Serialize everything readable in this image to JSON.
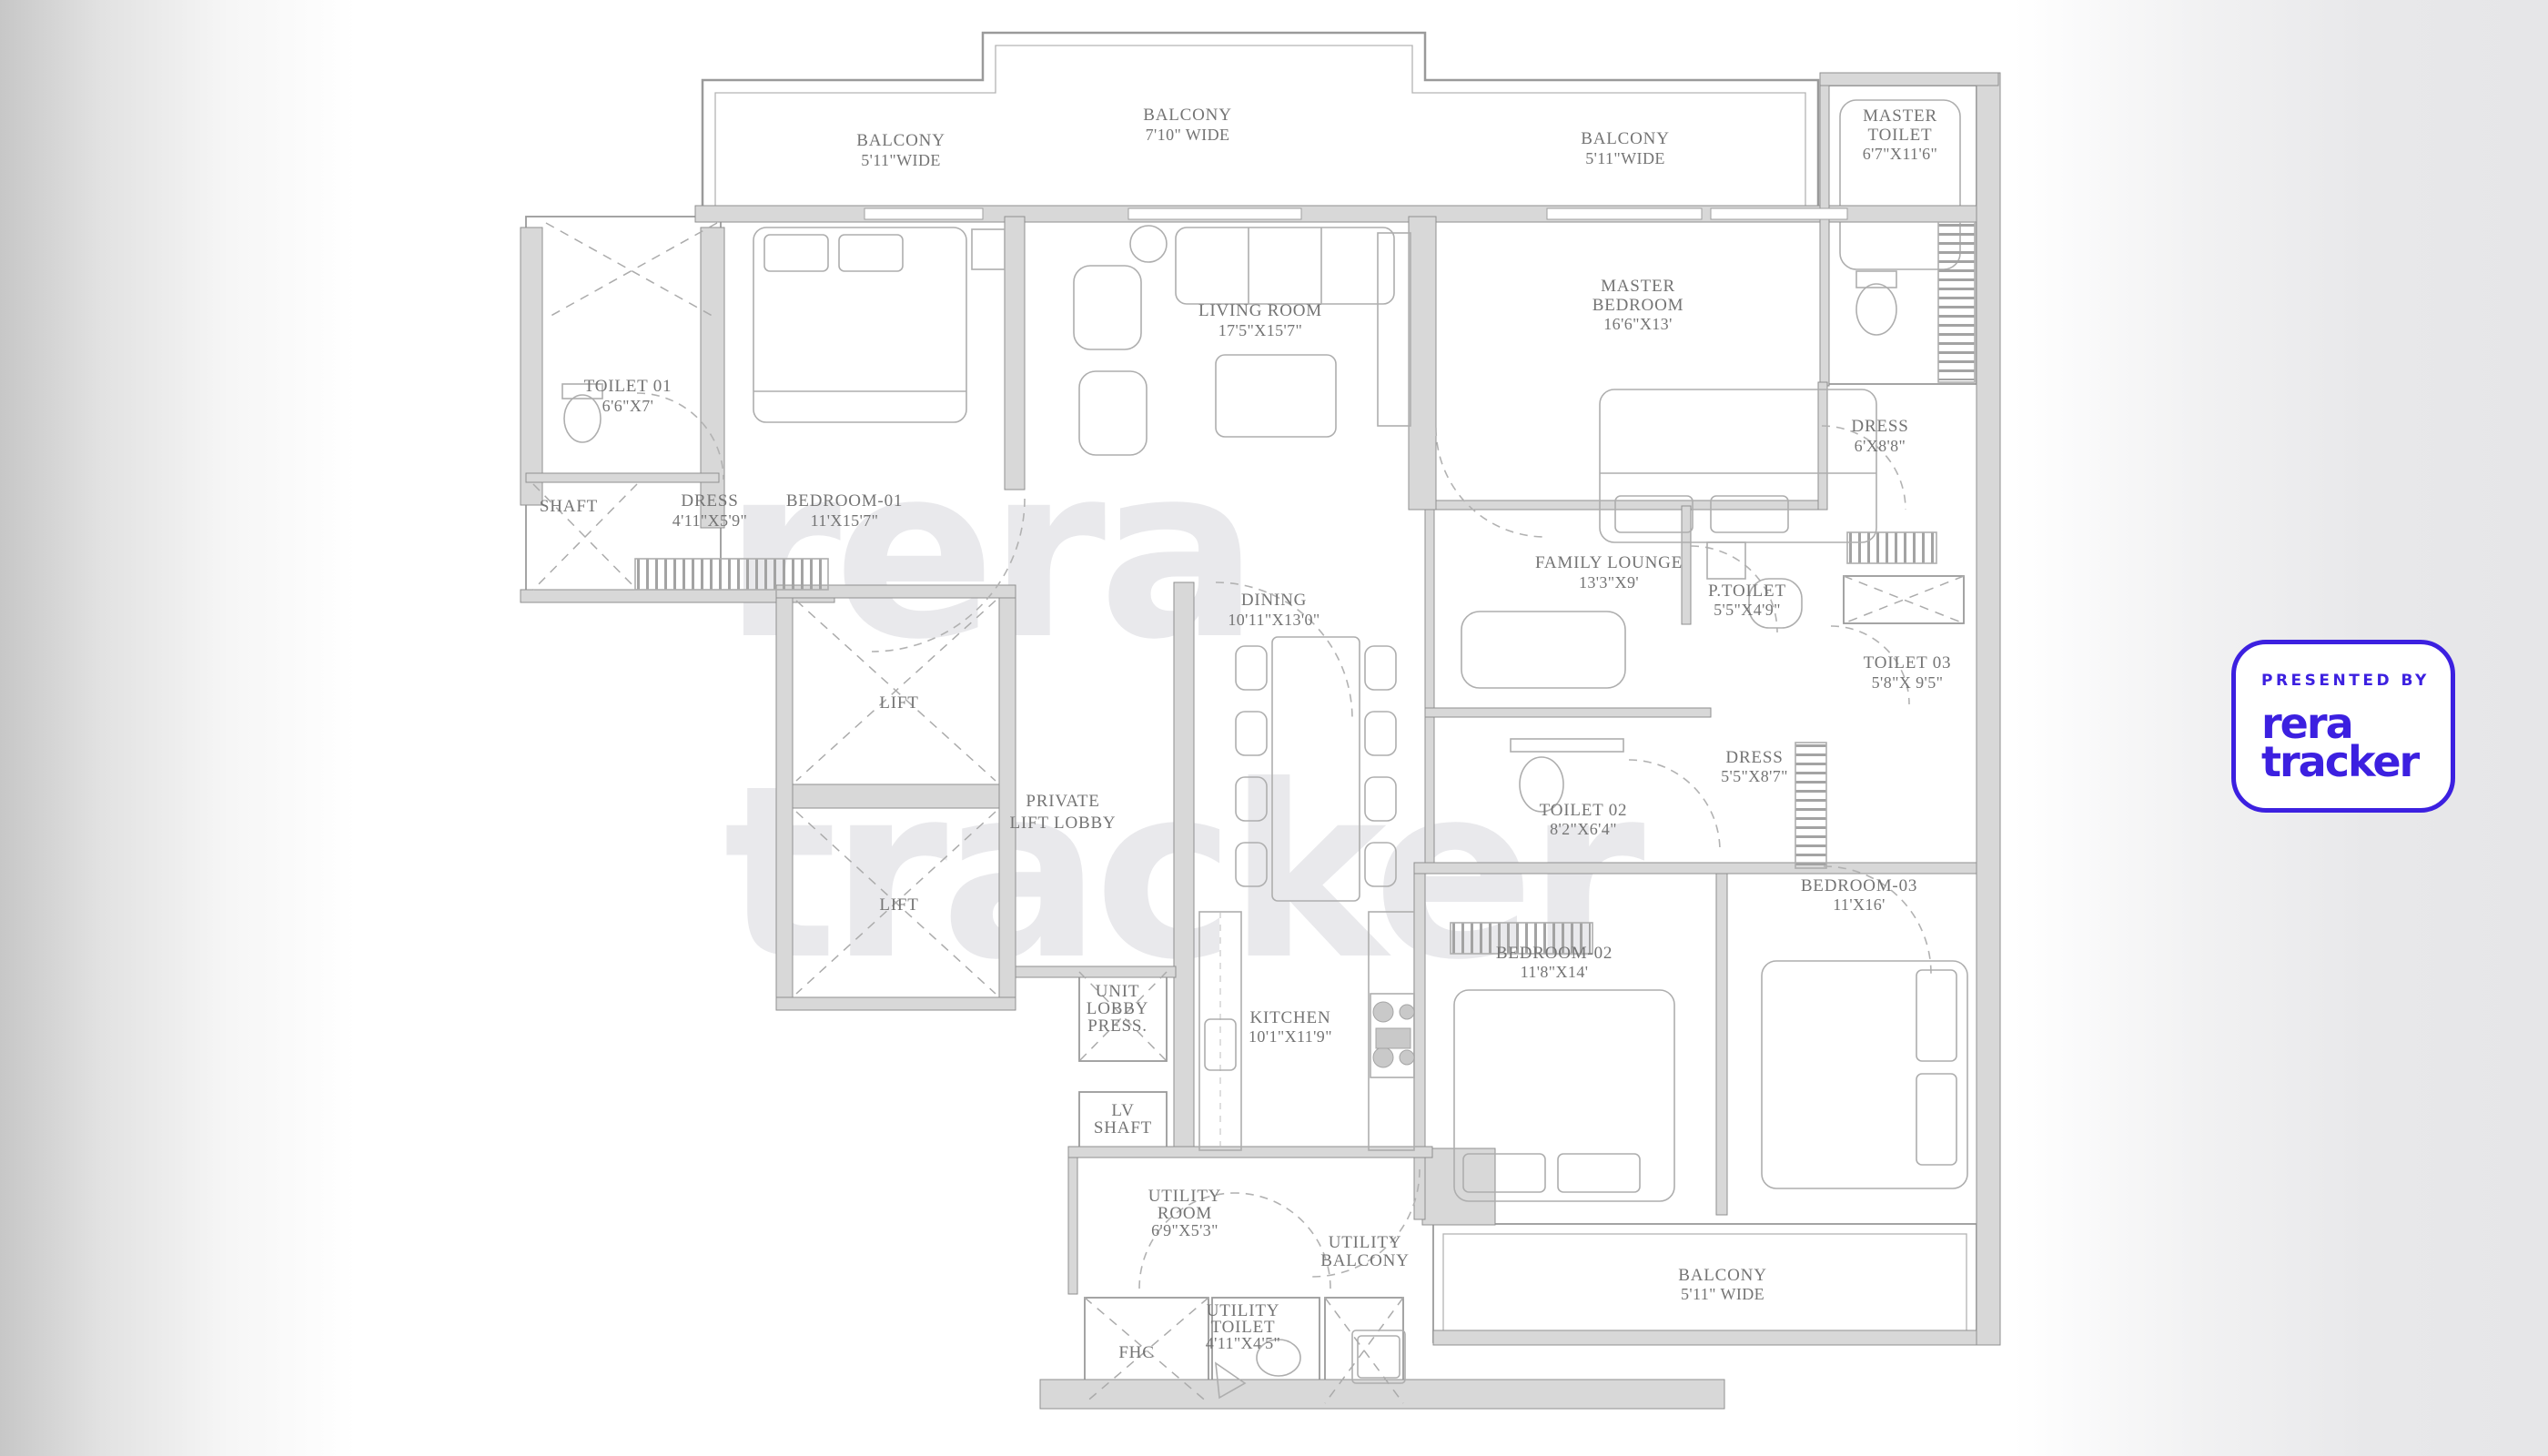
{
  "watermark": {
    "line1": "rera",
    "line2": "tracker"
  },
  "badge": {
    "presented_by": "PRESENTED BY",
    "brand_top": "rera",
    "brand_bottom": "tracker"
  },
  "colors": {
    "brand": "#3c20e0",
    "watermark": "#e9e9ec",
    "wall_fill": "#d8d8d8",
    "label_text": "#747474"
  },
  "rooms": {
    "balcony_top_left": {
      "lines": [
        "BALCONY",
        "5'11\"WIDE"
      ]
    },
    "balcony_top_center": {
      "lines": [
        "BALCONY",
        "7'10\" WIDE"
      ]
    },
    "balcony_top_right": {
      "lines": [
        "BALCONY",
        "5'11\"WIDE"
      ]
    },
    "master_toilet": {
      "lines": [
        "MASTER",
        "TOILET",
        "6'7\"X11'6\""
      ]
    },
    "living_room": {
      "lines": [
        "LIVING ROOM",
        "17'5\"X15'7\""
      ]
    },
    "master_bedroom": {
      "lines": [
        "MASTER",
        "BEDROOM",
        "16'6\"X13'"
      ]
    },
    "toilet_01": {
      "lines": [
        "TOILET 01",
        "6'6\"X7'"
      ]
    },
    "shaft": {
      "lines": [
        "SHAFT"
      ]
    },
    "dress_01": {
      "lines": [
        "DRESS",
        "4'11\"X5'9\""
      ]
    },
    "bedroom_01": {
      "lines": [
        "BEDROOM-01",
        "11'X15'7\""
      ]
    },
    "dress_master": {
      "lines": [
        "DRESS",
        "6'X8'8\""
      ]
    },
    "family_lounge": {
      "lines": [
        "FAMILY LOUNGE",
        "13'3\"X9'"
      ]
    },
    "p_toilet": {
      "lines": [
        "P.TOILET",
        "5'5\"X4'9\""
      ]
    },
    "toilet_03": {
      "lines": [
        "TOILET 03",
        "5'8\"X 9'5\""
      ]
    },
    "dining": {
      "lines": [
        "DINING",
        "10'11\"X13'0\""
      ]
    },
    "lift_1": {
      "lines": [
        "LIFT"
      ]
    },
    "lift_2": {
      "lines": [
        "LIFT"
      ]
    },
    "private_lift_lobby": {
      "lines": [
        "PRIVATE",
        "LIFT LOBBY"
      ]
    },
    "dress_03": {
      "lines": [
        "DRESS",
        "5'5\"X8'7\""
      ]
    },
    "toilet_02": {
      "lines": [
        "TOILET 02",
        "8'2\"X6'4\""
      ]
    },
    "bedroom_02": {
      "lines": [
        "BEDROOM-02",
        "11'8\"X14'"
      ]
    },
    "bedroom_03": {
      "lines": [
        "BEDROOM-03",
        "11'X16'"
      ]
    },
    "kitchen": {
      "lines": [
        "KITCHEN",
        "10'1\"X11'9\""
      ]
    },
    "unit_lobby_press": {
      "lines": [
        "UNIT",
        "LOBBY",
        "PRESS."
      ]
    },
    "lv_shaft": {
      "lines": [
        "LV",
        "SHAFT"
      ]
    },
    "utility_room": {
      "lines": [
        "UTILITY",
        "ROOM",
        "6'9\"X5'3\""
      ]
    },
    "utility_balcony": {
      "lines": [
        "UTILITY",
        "BALCONY"
      ]
    },
    "utility_toilet": {
      "lines": [
        "UTILITY",
        "TOILET",
        "4'11\"X4'5\""
      ]
    },
    "fhc": {
      "lines": [
        "FHC"
      ]
    },
    "balcony_bottom": {
      "lines": [
        "BALCONY",
        "5'11\" WIDE"
      ]
    }
  }
}
